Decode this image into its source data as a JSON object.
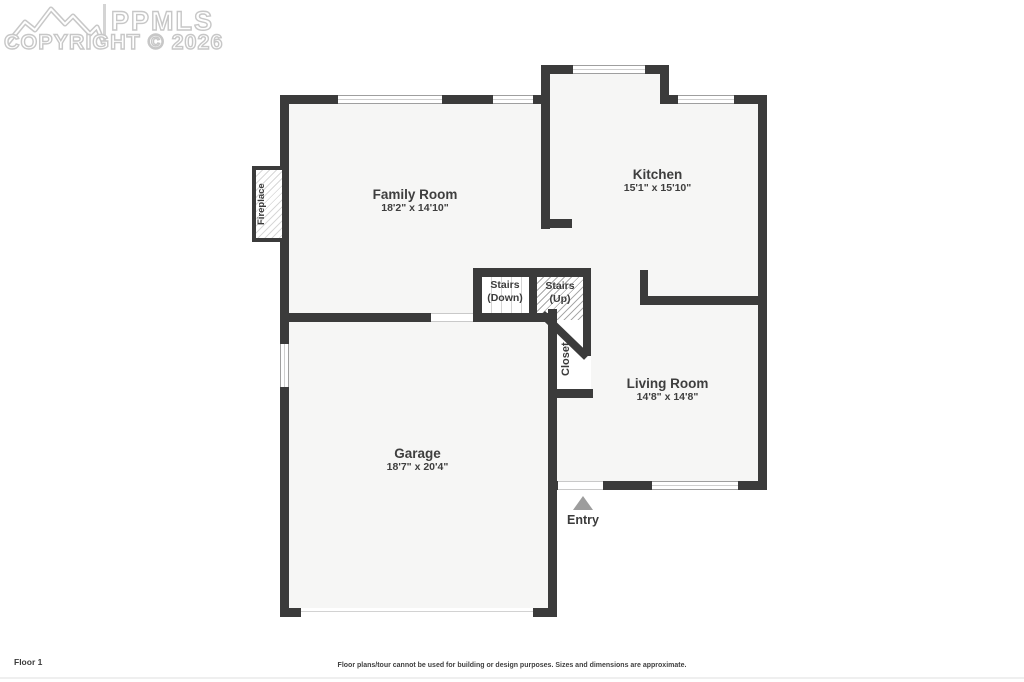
{
  "watermark": {
    "brand": "PPMLS",
    "copyright": "COPYRIGHT © 2026"
  },
  "floor_label": "Floor 1",
  "disclaimer": "Floor plans/tour cannot be used for building or design purposes. Sizes and dimensions are approximate.",
  "rooms": [
    {
      "name": "Family Room",
      "dimensions": "18'2\" x 14'10\""
    },
    {
      "name": "Kitchen",
      "dimensions": "15'1\" x 15'10\""
    },
    {
      "name": "Living Room",
      "dimensions": "14'8\" x 14'8\""
    },
    {
      "name": "Garage",
      "dimensions": "18'7\" x 20'4\""
    }
  ],
  "features": {
    "stairs_down_line1": "Stairs",
    "stairs_down_line2": "(Down)",
    "stairs_up_line1": "Stairs",
    "stairs_up_line2": "(Up)",
    "closet": "Closet",
    "fireplace": "Fireplace",
    "entry": "Entry"
  },
  "colors": {
    "wall": "#3b3b3b",
    "floor": "#f6f6f5",
    "watermark": "#c7c7c7",
    "entry_arrow": "#9d9d9d"
  }
}
